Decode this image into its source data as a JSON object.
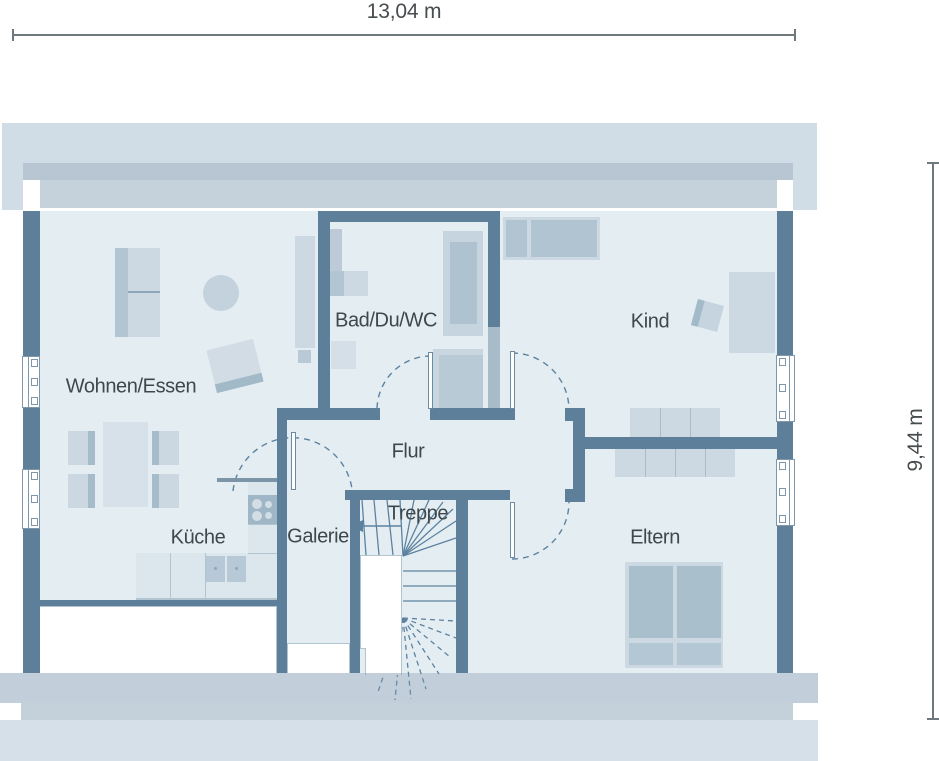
{
  "plan": {
    "type": "floor-plan",
    "dimension_labels": {
      "width": "13,04 m",
      "height": "9,44 m"
    },
    "rooms": {
      "wohnen_essen": "Wohnen/Essen",
      "kueche": "Küche",
      "galerie": "Galerie",
      "treppe": "Treppe",
      "flur": "Flur",
      "bad": "Bad/Du/WC",
      "kind": "Kind",
      "eltern": "Eltern"
    },
    "colors": {
      "wall": "#5e7f9a",
      "wall_light": "#a7bbc9",
      "room_fill": "#e4eef2",
      "eaves_outer": "#d1dde6",
      "eaves_mid": "#b7c6d2",
      "eaves_inner": "#c5d2dc",
      "bottom_band": "#c4d0da",
      "furniture_light": "#ccd9e3",
      "furniture_medium": "#b0c4d1",
      "counter": "#dce6ed",
      "stair_line": "#5d82a0",
      "label_text": "#3d474e",
      "dimension_line": "#6f787d",
      "void_fill": "#ffffff"
    }
  }
}
